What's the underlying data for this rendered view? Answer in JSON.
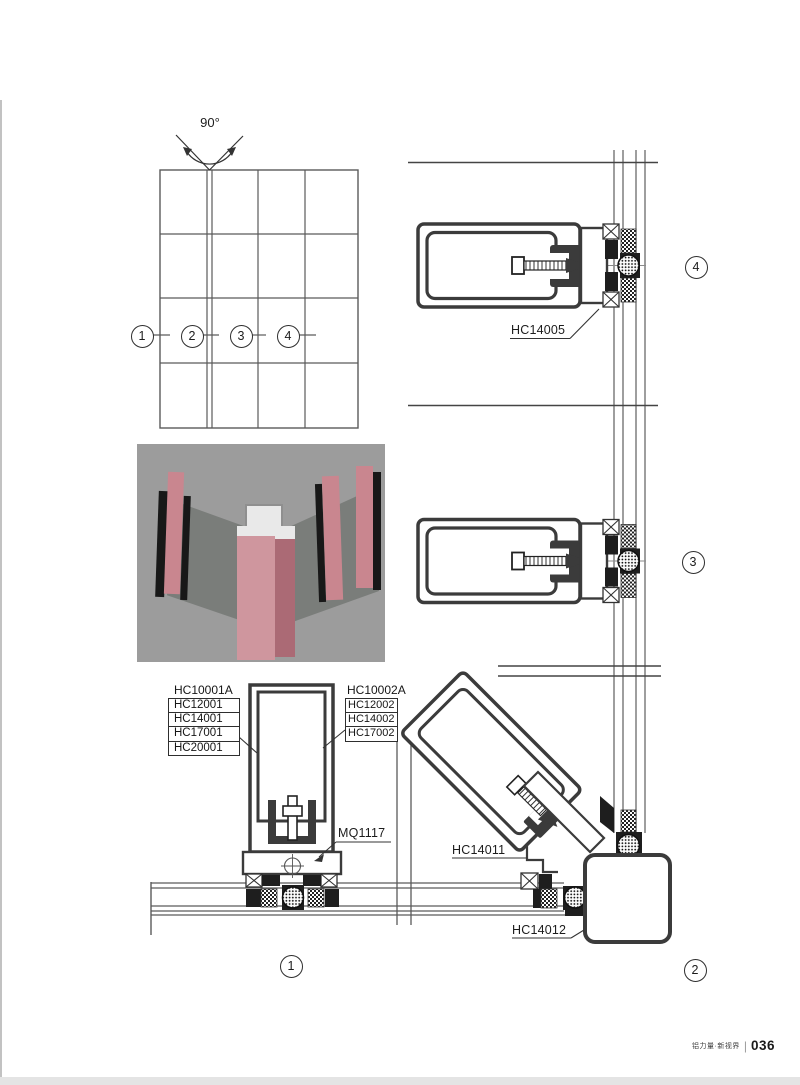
{
  "angle_label": "90°",
  "grid_callouts": [
    "1",
    "2",
    "3",
    "4"
  ],
  "detail_callouts": {
    "d1": "1",
    "d2": "2",
    "d3": "3",
    "d4": "4"
  },
  "labels": {
    "hc14005": "HC14005",
    "mq1117": "MQ1117",
    "hc14011": "HC14011",
    "hc14012": "HC14012"
  },
  "left_stack": {
    "header": "HC10001A",
    "items": [
      "HC12001",
      "HC14001",
      "HC17001",
      "HC20001"
    ]
  },
  "right_stack": {
    "header": "HC10002A",
    "items": [
      "HC12002",
      "HC14002",
      "HC17002"
    ]
  },
  "footer": {
    "brand": "铝力量·新视界",
    "separator": "|",
    "page_number": "036"
  },
  "colors": {
    "line_dark": "#3b3b3b",
    "line_thin": "#5a5a5a",
    "render_bg": "#9c9c9c",
    "render_pink": "#c9868f",
    "scan_edge": "#e4e4e4"
  }
}
